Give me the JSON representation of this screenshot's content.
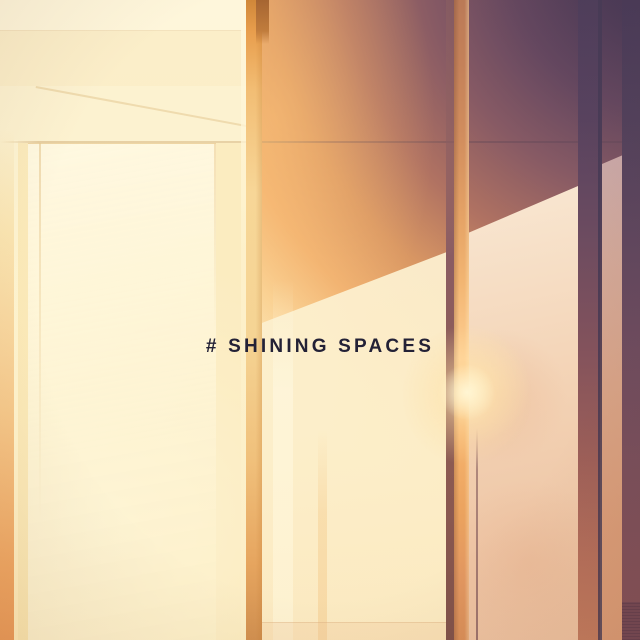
{
  "artwork": {
    "title": "# SHINING SPACES",
    "title_color": "#232136",
    "palette": {
      "cream": "#fcf2d2",
      "gold": "#f7d697",
      "orange": "#e89e4d",
      "terracotta": "#bb7a57",
      "peach": "#eec6a6",
      "mauve": "#875a64",
      "purple": "#3e3456",
      "highlight": "#ffcf92"
    }
  }
}
